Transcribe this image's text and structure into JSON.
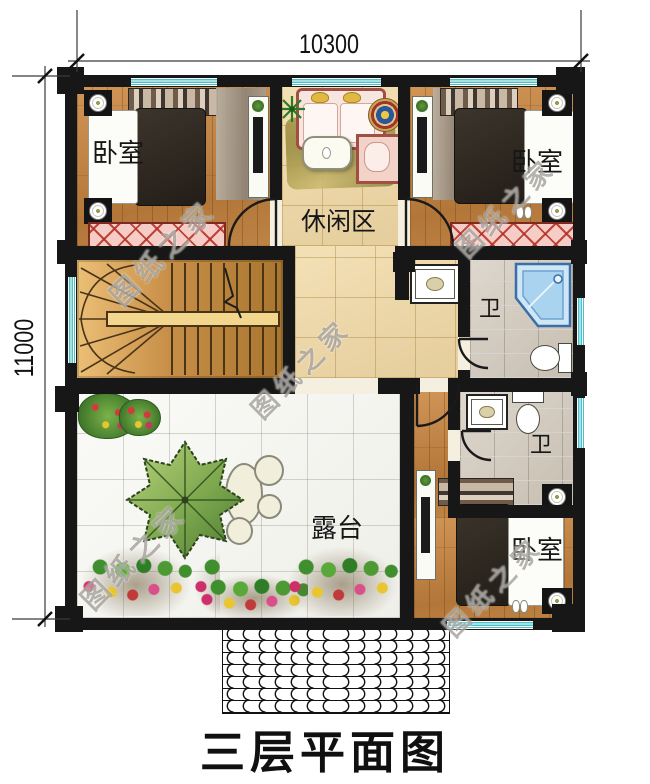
{
  "title": "三层平面图",
  "dimensions": {
    "top": "10300",
    "left": "11000"
  },
  "rooms": {
    "bedroom_left": {
      "label": "卧室"
    },
    "bedroom_right": {
      "label": "卧室"
    },
    "bedroom_bottom": {
      "label": "卧室"
    },
    "leisure": {
      "label": "休闲区"
    },
    "bath_upper": {
      "label": "卫"
    },
    "bath_lower": {
      "label": "卫"
    },
    "terrace": {
      "label": "露台"
    }
  },
  "watermark": {
    "text": "图纸之家"
  },
  "colors": {
    "wall": "#171717",
    "window_glass": "#49c3c8",
    "wood_floor": "#c08549",
    "tile_floor": "#eed9ab",
    "terrace_tile": "#f8f8f5",
    "stone_tile": "#d9d2c8",
    "wardrobe_hatch": "#f4c9c2",
    "shower": "#a9d3ee",
    "stair_wood": "#d9a45b"
  }
}
